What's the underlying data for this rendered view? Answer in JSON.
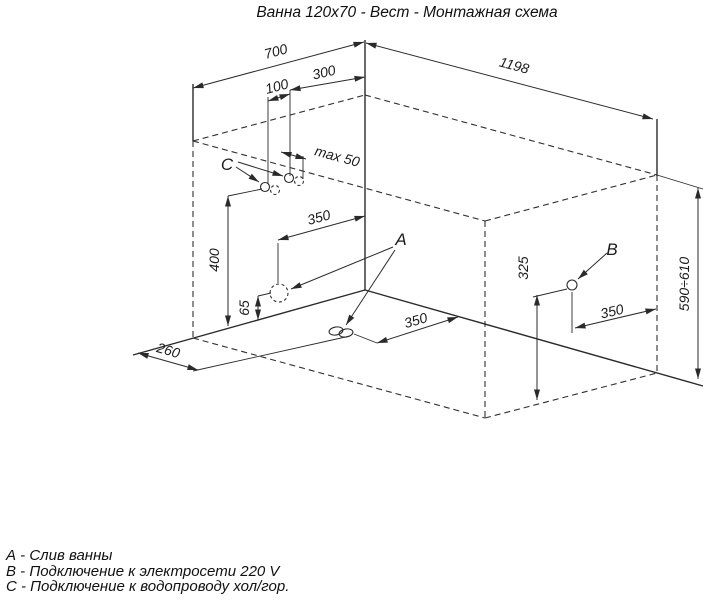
{
  "title": "Ванна 120x70 - Вест - Монтажная схема",
  "points": {
    "a": "A",
    "b": "B",
    "c": "C"
  },
  "dims": {
    "d700": "700",
    "d1198": "1198",
    "d300": "300",
    "d100": "100",
    "max50": "max 50",
    "d350_hole": "350",
    "d400": "400",
    "d65": "65",
    "d260": "260",
    "d350_drain": "350",
    "d325": "325",
    "d350_outlet": "350",
    "height": "590÷610"
  },
  "legend": {
    "line1": "А - Слив ванны",
    "line2": "В - Подключение к электросети 220 V",
    "line3": "С - Подключение к водопроводу хол/гор."
  }
}
